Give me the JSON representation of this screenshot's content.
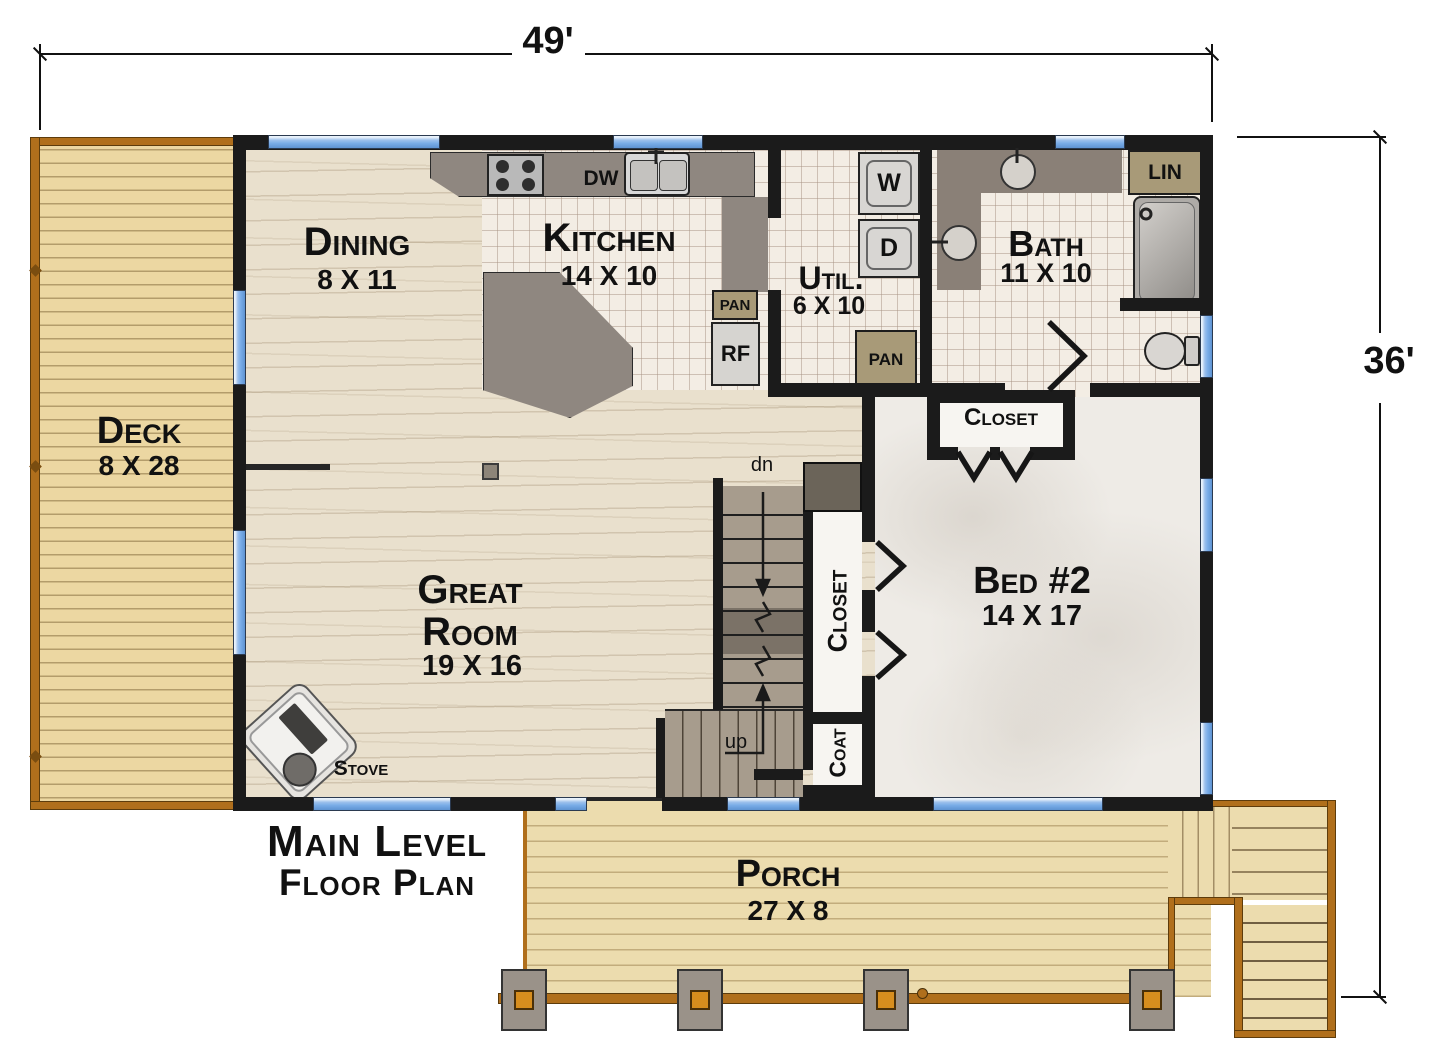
{
  "dimensions": {
    "width_label": "49'",
    "height_label": "36'"
  },
  "title": {
    "line1": "Main Level",
    "line2": "Floor Plan"
  },
  "rooms": {
    "deck": {
      "name": "Deck",
      "size": "8 X 28"
    },
    "dining": {
      "name": "Dining",
      "size": "8 X 11"
    },
    "kitchen": {
      "name": "Kitchen",
      "size": "14 X 10"
    },
    "utility": {
      "name": "Util.",
      "size": "6 X 10"
    },
    "bath": {
      "name": "Bath",
      "size": "11 X 10"
    },
    "bed2": {
      "name": "Bed #2",
      "size": "14 X 17"
    },
    "great_room": {
      "name_line1": "Great",
      "name_line2": "Room",
      "size": "19 X 16"
    },
    "porch": {
      "name": "Porch",
      "size": "27 X 8"
    },
    "closet_bed2": {
      "name": "Closet"
    },
    "closet_hall": {
      "name": "Closet"
    },
    "coat": {
      "name": "Coat"
    }
  },
  "fixtures": {
    "dishwasher": "DW",
    "washer": "W",
    "dryer": "D",
    "refrigerator": "RF",
    "pantry_kitchen": "PAN",
    "pantry_utility": "PAN",
    "linen": "LIN",
    "stove_label": "Stove"
  },
  "stairs": {
    "down_label": "dn",
    "up_label": "up"
  },
  "colors": {
    "wall": "#1b1b1b",
    "window": "#7aade8",
    "deck_wood": "#ecd7a2",
    "rail": "#b06f1c",
    "wood_floor": "#e9e0cd",
    "tile": "#f3ede4",
    "carpet": "#eeebe6",
    "counter": "#8f8780",
    "pantry_tan": "#a89a78",
    "appliance_gray": "#d8d6d3",
    "stair": "#a79c8d",
    "stair_dark": "#7b7267",
    "porch_wood": "#ecdcae"
  }
}
